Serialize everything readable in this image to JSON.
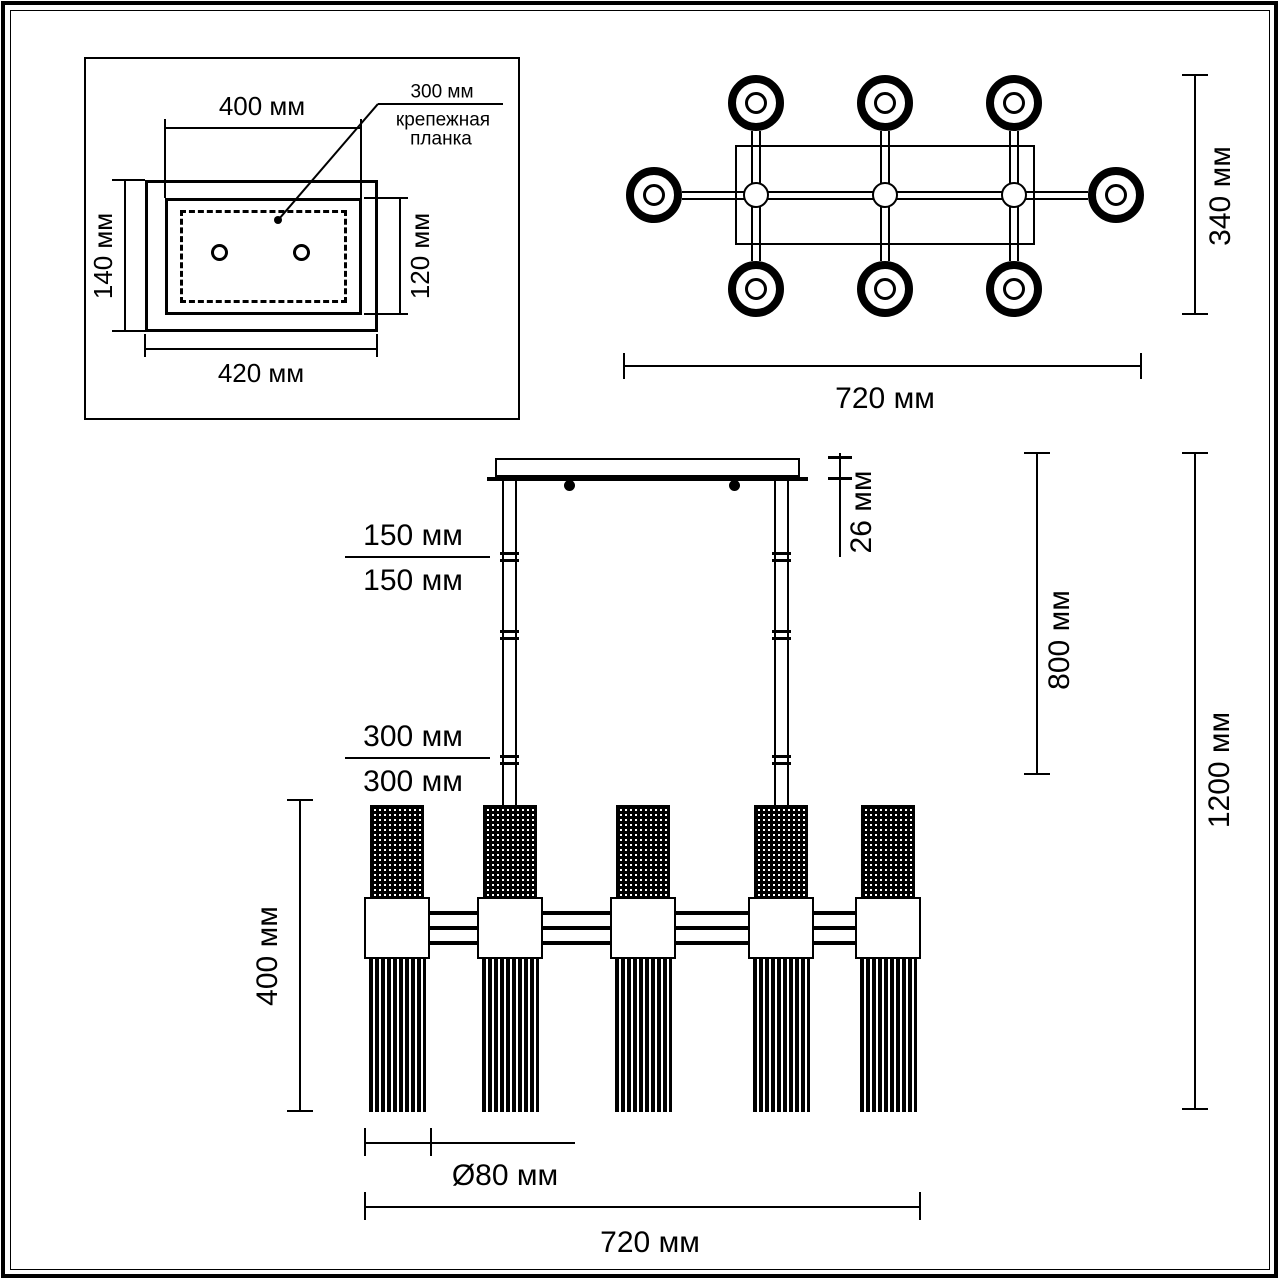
{
  "drawing": {
    "ink": "#000000",
    "paper": "#ffffff"
  },
  "inset": {
    "dim_inner_width": "400 мм",
    "dim_outer_width": "420 мм",
    "dim_outer_height": "140 мм",
    "dim_inner_height": "120 мм",
    "callout_value": "300 мм",
    "callout_line1": "крепежная",
    "callout_line2": "планка"
  },
  "top_view": {
    "dim_width": "720 мм",
    "dim_depth": "340 мм"
  },
  "side_view": {
    "cable_segment_1": "150 мм",
    "cable_segment_2": "150 мм",
    "cable_segment_3": "300 мм",
    "cable_segment_4": "300 мм",
    "dim_canopy_height": "26 мм",
    "dim_suspension": "800 мм",
    "dim_total_height": "1200 мм",
    "dim_shade_zone_height": "400 мм",
    "dim_shade_diameter": "Ø80 мм",
    "dim_total_width": "720 мм"
  }
}
